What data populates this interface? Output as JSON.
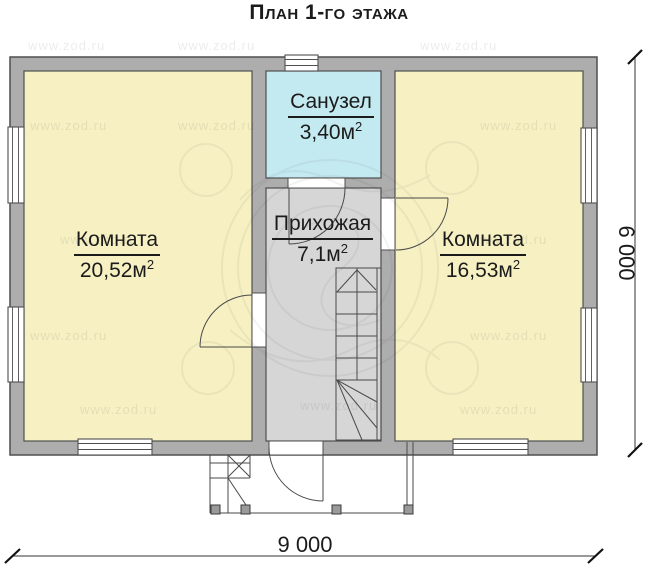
{
  "title": "План 1-го этажа",
  "rooms": {
    "bathroom": {
      "name": "Санузел",
      "area": "3,40м",
      "sup": "2"
    },
    "room_left": {
      "name": "Комната",
      "area": "20,52м",
      "sup": "2"
    },
    "hallway": {
      "name": "Прихожая",
      "area": "7,1м",
      "sup": "2"
    },
    "room_right": {
      "name": "Комната",
      "area": "16,53м",
      "sup": "2"
    }
  },
  "dimensions": {
    "width_label": "9 000",
    "height_label": "6 000"
  },
  "watermark": {
    "url": "www.zod.ru"
  },
  "colors": {
    "wall": "#adadad",
    "outline": "#4f4f4f",
    "room": "#f6f0c3",
    "bathroom": "#c3eaf0",
    "hallway": "#d6d6d6"
  }
}
